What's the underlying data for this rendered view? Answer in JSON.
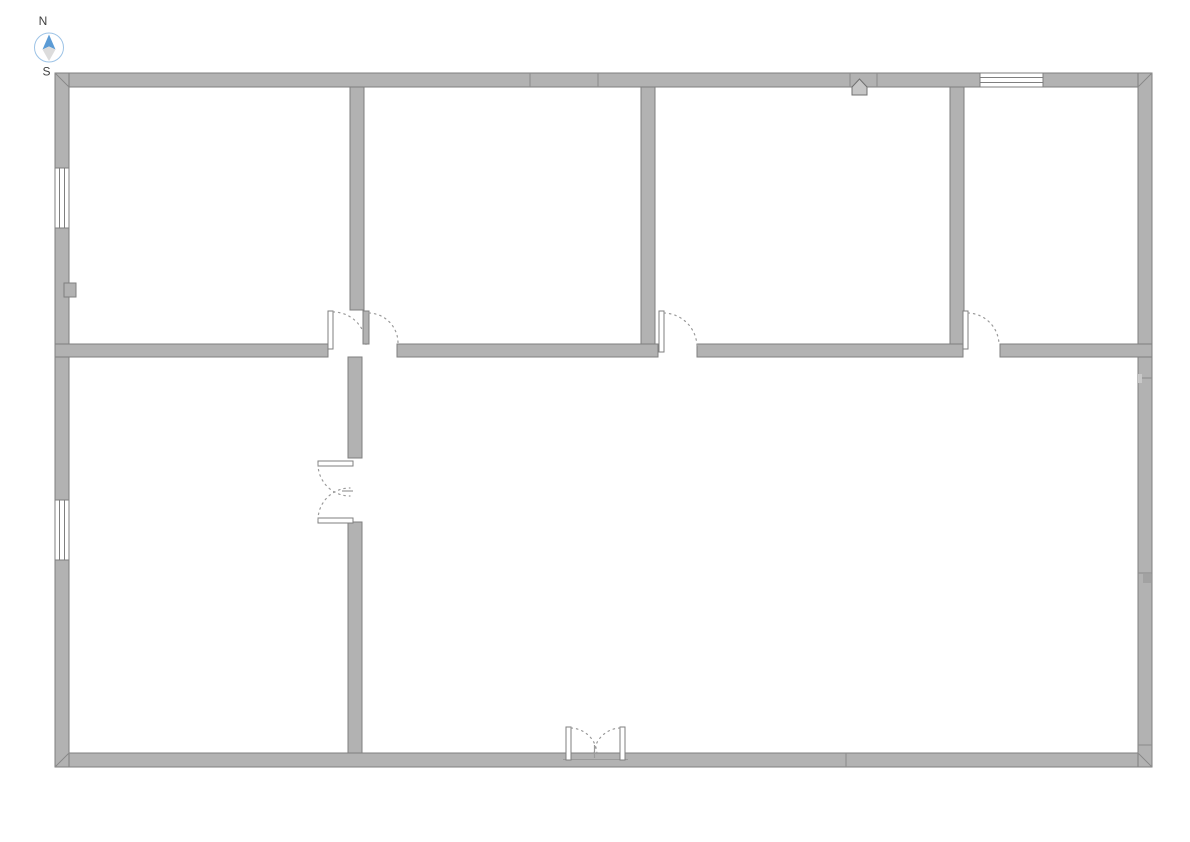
{
  "page": {
    "title": "Floor Plan"
  },
  "compass": {
    "north_label": "N",
    "south_label": "S"
  },
  "colors": {
    "page_bg": "#ffffff",
    "wall_fill": "#b2b2b2",
    "wall_outline": "#7f7f7f",
    "window_fill": "#ffffff",
    "door_leaf_fill": "#ffffff",
    "door_swing": "#9a9a9a",
    "seam": "#8b8b8b",
    "compass_north": "#5b9bd5",
    "compass_south": "#dcdcdc",
    "compass_ring": "#9dc3e6",
    "label_text": "#404040"
  },
  "plan": {
    "top_room_count": 4,
    "bottom_room_count": 2,
    "windows": [
      {
        "id": "window-west-upper",
        "wall": "west",
        "glazing_lines": 2
      },
      {
        "id": "window-west-lower",
        "wall": "west",
        "glazing_lines": 2
      },
      {
        "id": "window-north-right",
        "wall": "north",
        "glazing_lines": 2
      }
    ],
    "doors": [
      {
        "id": "door-top-room-1",
        "type": "single",
        "swing": "into-room"
      },
      {
        "id": "door-top-room-2",
        "type": "single",
        "swing": "into-room"
      },
      {
        "id": "door-top-room-3",
        "type": "single",
        "swing": "into-room"
      },
      {
        "id": "door-top-room-4",
        "type": "single",
        "swing": "into-room"
      },
      {
        "id": "double-door-interior",
        "type": "double",
        "swing": "west"
      },
      {
        "id": "double-door-entrance",
        "type": "double",
        "swing": "north"
      }
    ],
    "fixtures": [
      {
        "id": "north-wall-sensor",
        "shape": "pentagon"
      },
      {
        "id": "west-wall-outlet",
        "shape": "square"
      }
    ]
  }
}
